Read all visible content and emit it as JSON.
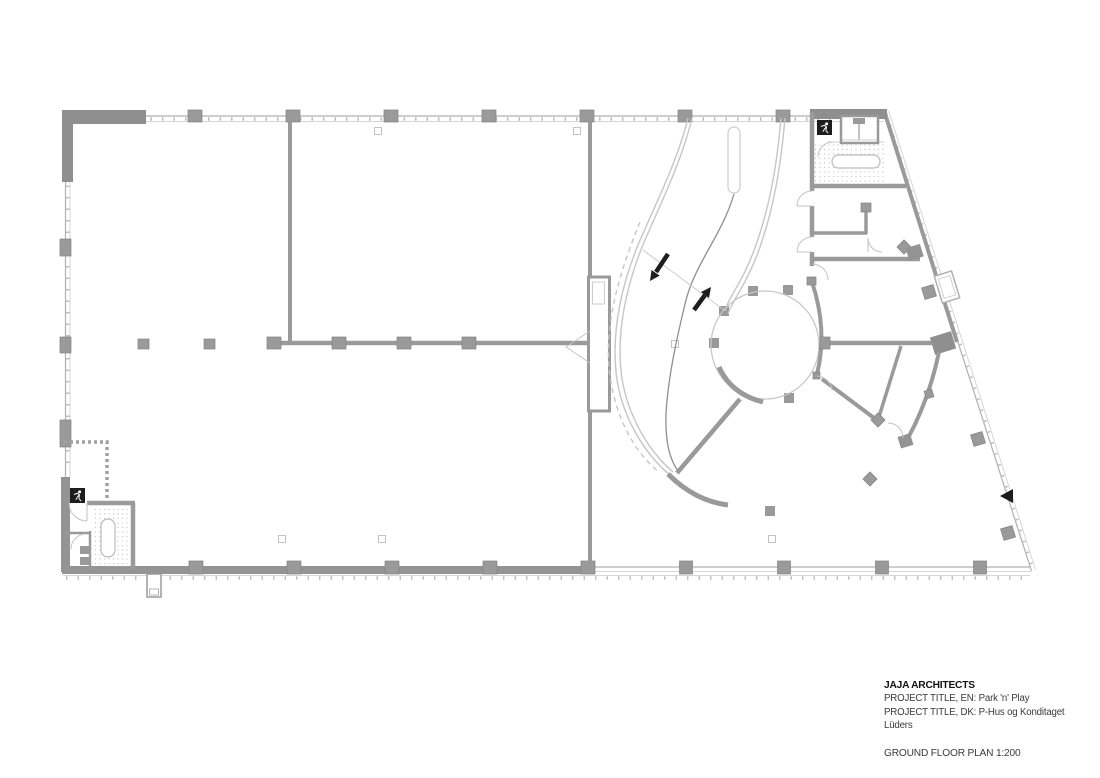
{
  "page": {
    "background": "#ffffff"
  },
  "title_block": {
    "architect": "JAJA ARCHITECTS",
    "project_title_en": "PROJECT TITLE, EN: Park 'n' Play",
    "project_title_dk": "PROJECT TITLE, DK: P-Hus og Konditaget Lüders",
    "drawing_title": "GROUND FLOOR PLAN 1:200"
  },
  "drawing": {
    "kind": "architectural ground floor plan",
    "scale": "1:200",
    "icons": [
      "exit-sign-icon",
      "exit-sign-icon",
      "elevator-icon",
      "ramp-down-arrow-icon",
      "ramp-up-arrow-icon",
      "entrance-arrow-icon"
    ],
    "ramp_directions": [
      "down",
      "up"
    ],
    "exit_sign_count": 2,
    "colors": {
      "walls": "#9a9a9a",
      "facade_lines": "#b0b0b0",
      "light_lines": "#c6c6c6",
      "ink_black": "#1d1d1d",
      "paper": "#ffffff"
    }
  }
}
